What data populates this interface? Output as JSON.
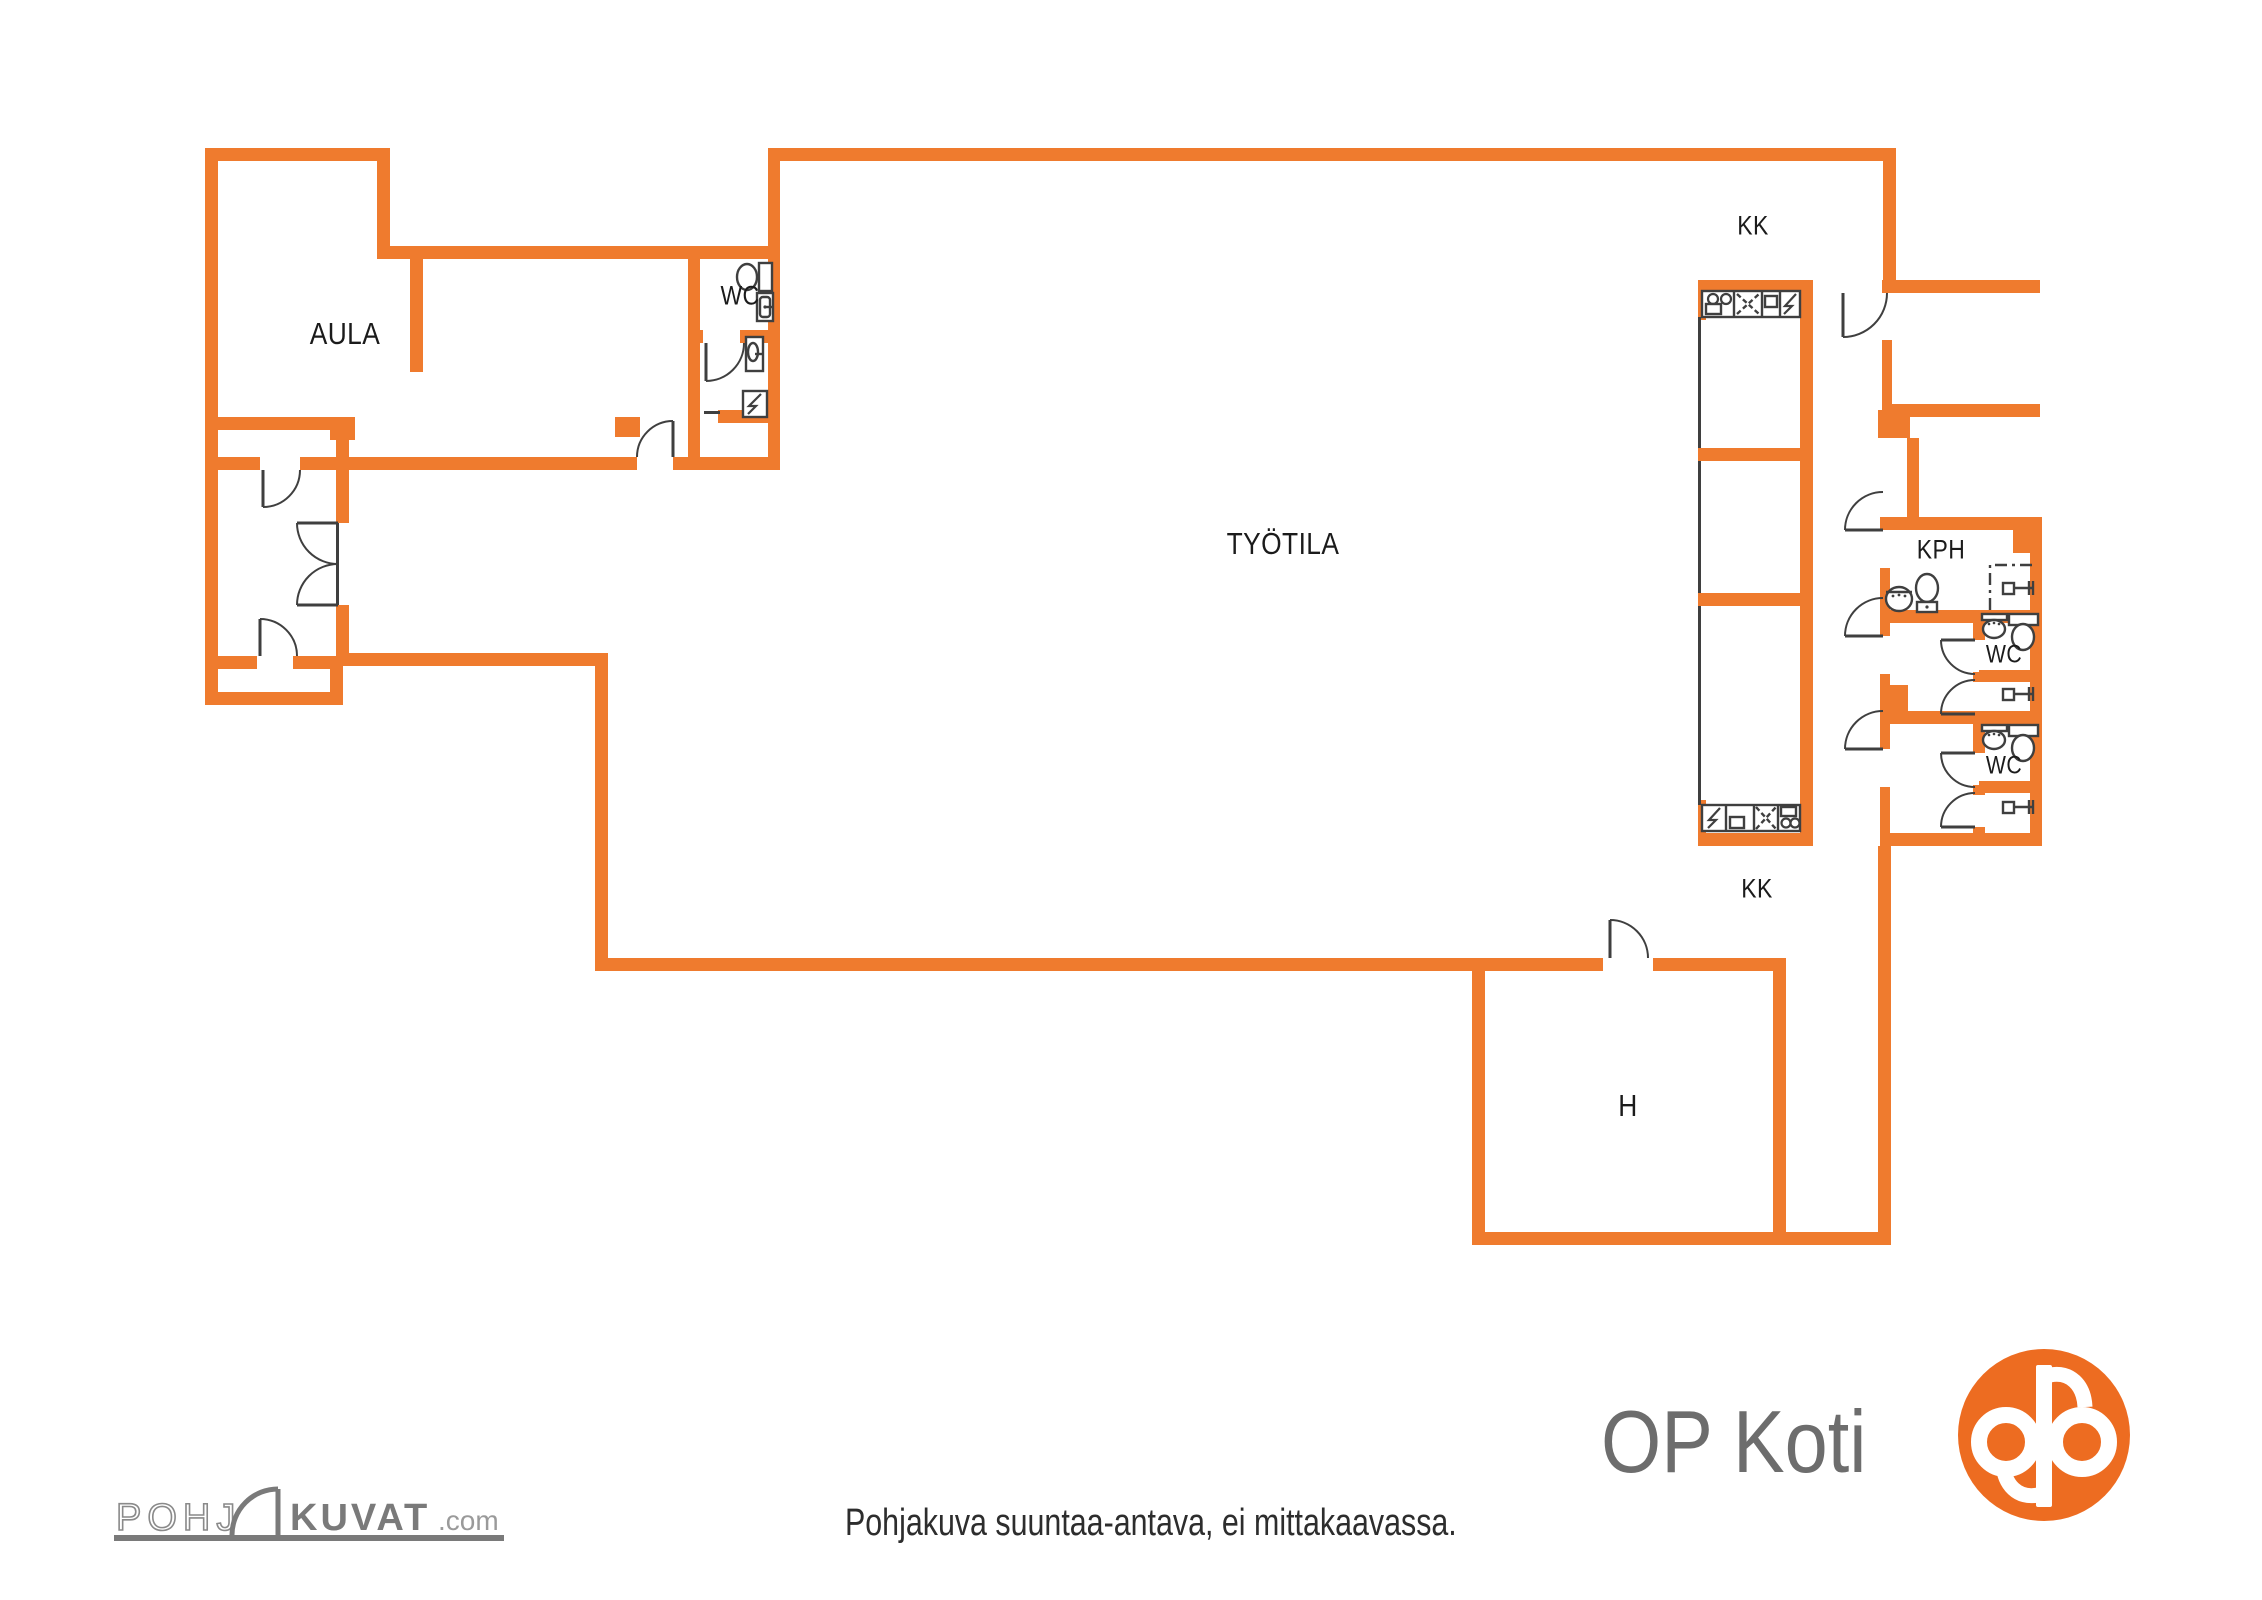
{
  "colors": {
    "wall": "#EF7B2E",
    "line": "#3f3f3f",
    "label": "#1b1b1b",
    "logo_orange": "#ED6C21",
    "logo_gray": "#6d6d6d",
    "watermark_gray": "#7a7a7a"
  },
  "footer": {
    "disclaimer": "Pohjakuva suuntaa-antava, ei mittakaavassa.",
    "brand": "OP Koti",
    "watermark_left": "POHJ",
    "watermark_mid": "KUVAT",
    "watermark_suffix": ".com"
  },
  "rooms": [
    {
      "text": "AULA",
      "x": 345,
      "y": 334,
      "size": 31
    },
    {
      "text": "WC",
      "x": 740,
      "y": 296,
      "size": 27
    },
    {
      "text": "TYÖTILA",
      "x": 1283,
      "y": 544,
      "size": 31
    },
    {
      "text": "KK",
      "x": 1753,
      "y": 226,
      "size": 27
    },
    {
      "text": "KK",
      "x": 1757,
      "y": 889,
      "size": 27
    },
    {
      "text": "KPH",
      "x": 1941,
      "y": 550,
      "size": 27
    },
    {
      "text": "WC",
      "x": 2004,
      "y": 655,
      "size": 25
    },
    {
      "text": "WC",
      "x": 2004,
      "y": 766,
      "size": 25
    },
    {
      "text": "H",
      "x": 1628,
      "y": 1106,
      "size": 31
    }
  ],
  "plan": {
    "width": 2262,
    "height": 1600,
    "walls": [
      [
        205,
        148,
        185,
        13
      ],
      [
        205,
        148,
        13,
        557
      ],
      [
        377,
        148,
        13,
        111
      ],
      [
        377,
        246,
        403,
        13
      ],
      [
        410,
        259,
        13,
        113
      ],
      [
        218,
        417,
        116,
        13
      ],
      [
        330,
        417,
        25,
        23
      ],
      [
        336,
        437,
        13,
        33
      ],
      [
        218,
        457,
        42,
        13
      ],
      [
        300,
        457,
        337,
        13
      ],
      [
        673,
        457,
        107,
        13
      ],
      [
        336,
        470,
        13,
        53
      ],
      [
        336,
        605,
        13,
        51
      ],
      [
        218,
        656,
        39,
        13
      ],
      [
        293,
        656,
        50,
        13
      ],
      [
        205,
        692,
        138,
        13
      ],
      [
        330,
        656,
        13,
        49
      ],
      [
        688,
        259,
        12,
        75
      ],
      [
        688,
        330,
        15,
        13
      ],
      [
        740,
        330,
        40,
        13
      ],
      [
        688,
        343,
        12,
        114
      ],
      [
        768,
        148,
        12,
        322
      ],
      [
        718,
        410,
        62,
        13
      ],
      [
        615,
        417,
        25,
        20
      ],
      [
        768,
        148,
        1121,
        13
      ],
      [
        595,
        653,
        13,
        318
      ],
      [
        336,
        653,
        272,
        13
      ],
      [
        595,
        958,
        1008,
        13
      ],
      [
        1653,
        958,
        124,
        13
      ],
      [
        1472,
        958,
        13,
        287
      ],
      [
        1773,
        958,
        13,
        287
      ],
      [
        1472,
        1232,
        419,
        13
      ],
      [
        1878,
        846,
        13,
        399
      ],
      [
        1698,
        280,
        115,
        13
      ],
      [
        1800,
        280,
        13,
        566
      ],
      [
        1698,
        448,
        102,
        13
      ],
      [
        1698,
        593,
        102,
        13
      ],
      [
        1698,
        833,
        115,
        13
      ],
      [
        1698,
        280,
        8,
        40
      ],
      [
        1698,
        800,
        8,
        46
      ],
      [
        1883,
        148,
        13,
        145
      ],
      [
        1882,
        280,
        158,
        13
      ],
      [
        1882,
        340,
        10,
        77
      ],
      [
        1882,
        404,
        158,
        13
      ],
      [
        1878,
        410,
        32,
        28
      ],
      [
        1907,
        438,
        12,
        80
      ],
      [
        1880,
        517,
        162,
        13
      ],
      [
        2013,
        517,
        29,
        36
      ],
      [
        2030,
        517,
        12,
        329
      ],
      [
        1880,
        568,
        10,
        54
      ],
      [
        1880,
        610,
        162,
        13
      ],
      [
        1880,
        623,
        10,
        13
      ],
      [
        1880,
        674,
        10,
        50
      ],
      [
        1973,
        623,
        12,
        17
      ],
      [
        1973,
        672,
        12,
        10
      ],
      [
        1973,
        714,
        12,
        10
      ],
      [
        1979,
        670,
        63,
        12
      ],
      [
        1880,
        711,
        162,
        13
      ],
      [
        1880,
        685,
        28,
        26
      ],
      [
        1880,
        724,
        10,
        25
      ],
      [
        1880,
        787,
        10,
        59
      ],
      [
        1973,
        724,
        12,
        29
      ],
      [
        1973,
        785,
        12,
        10
      ],
      [
        1973,
        827,
        12,
        18
      ],
      [
        1979,
        781,
        63,
        12
      ],
      [
        1880,
        833,
        162,
        13
      ]
    ],
    "glass": [
      [
        1698,
        317,
        3,
        131
      ],
      [
        1698,
        461,
        3,
        132
      ],
      [
        1698,
        606,
        3,
        199
      ],
      [
        336,
        523,
        3,
        82
      ],
      [
        704,
        411,
        16,
        3
      ]
    ],
    "doors": [
      {
        "leaf": [
          263,
          470,
          263,
          507
        ],
        "arc": "M263,507 A37,37 0 0 0 300,470"
      },
      {
        "leaf": [
          297,
          523,
          338,
          523
        ],
        "arc": "M297,523 A41,41 0 0 0 338,564"
      },
      {
        "leaf": [
          297,
          605,
          338,
          605
        ],
        "arc": "M297,605 A41,41 0 0 1 338,564"
      },
      {
        "leaf": [
          260,
          619,
          260,
          656
        ],
        "arc": "M260,619 A37,37 0 0 1 297,656"
      },
      {
        "leaf": [
          706,
          343,
          706,
          381
        ],
        "arc": "M706,381 A38,38 0 0 0 744,343"
      },
      {
        "leaf": [
          673,
          421,
          673,
          457
        ],
        "arc": "M637,457 A36,36 0 0 1 673,421"
      },
      {
        "leaf": [
          1843,
          293,
          1843,
          337
        ],
        "arc": "M1843,337 A44,44 0 0 0 1887,293"
      },
      {
        "leaf": [
          1845,
          530,
          1883,
          530
        ],
        "arc": "M1845,530 A38,38 0 0 1 1883,492"
      },
      {
        "leaf": [
          1845,
          636,
          1883,
          636
        ],
        "arc": "M1845,636 A38,38 0 0 1 1883,598"
      },
      {
        "leaf": [
          1941,
          640,
          1975,
          640
        ],
        "arc": "M1941,640 A34,34 0 0 0 1975,674"
      },
      {
        "leaf": [
          1941,
          714,
          1975,
          714
        ],
        "arc": "M1941,714 A34,34 0 0 1 1975,680"
      },
      {
        "leaf": [
          1845,
          749,
          1883,
          749
        ],
        "arc": "M1845,749 A38,38 0 0 1 1883,711"
      },
      {
        "leaf": [
          1941,
          753,
          1975,
          753
        ],
        "arc": "M1941,753 A34,34 0 0 0 1975,787"
      },
      {
        "leaf": [
          1941,
          827,
          1975,
          827
        ],
        "arc": "M1941,827 A34,34 0 0 1 1975,793"
      },
      {
        "leaf": [
          1610,
          920,
          1610,
          958
        ],
        "arc": "M1610,920 A38,38 0 0 1 1648,958"
      }
    ],
    "fixtures": [
      {
        "t": "rect",
        "x": 1702,
        "y": 291,
        "w": 98,
        "h": 26
      },
      {
        "t": "line",
        "x1": 1734,
        "y1": 291,
        "x2": 1734,
        "y2": 317
      },
      {
        "t": "line",
        "x1": 1762,
        "y1": 291,
        "x2": 1762,
        "y2": 317
      },
      {
        "t": "line",
        "x1": 1780,
        "y1": 291,
        "x2": 1780,
        "y2": 317
      },
      {
        "t": "circle",
        "cx": 1713,
        "cy": 299,
        "r": 5
      },
      {
        "t": "circle",
        "cx": 1726,
        "cy": 299,
        "r": 5
      },
      {
        "t": "rect",
        "x": 1706,
        "y": 304,
        "w": 15,
        "h": 10
      },
      {
        "t": "line",
        "x1": 1737,
        "y1": 294,
        "x2": 1759,
        "y2": 314,
        "dash": "5 3"
      },
      {
        "t": "line",
        "x1": 1737,
        "y1": 314,
        "x2": 1759,
        "y2": 294,
        "dash": "5 3"
      },
      {
        "t": "rect",
        "x": 1765,
        "y": 296,
        "w": 12,
        "h": 11
      },
      {
        "t": "poly",
        "pts": "1796,294 1785,306 1792,306 1784,314"
      },
      {
        "t": "rect",
        "x": 1702,
        "y": 805,
        "w": 98,
        "h": 26
      },
      {
        "t": "line",
        "x1": 1726,
        "y1": 805,
        "x2": 1726,
        "y2": 831
      },
      {
        "t": "line",
        "x1": 1754,
        "y1": 805,
        "x2": 1754,
        "y2": 831
      },
      {
        "t": "line",
        "x1": 1778,
        "y1": 805,
        "x2": 1778,
        "y2": 831
      },
      {
        "t": "poly",
        "pts": "1720,808 1709,820 1716,820 1708,828"
      },
      {
        "t": "rect",
        "x": 1730,
        "y": 817,
        "w": 14,
        "h": 11
      },
      {
        "t": "line",
        "x1": 1756,
        "y1": 807,
        "x2": 1776,
        "y2": 829,
        "dash": "5 3"
      },
      {
        "t": "line",
        "x1": 1756,
        "y1": 829,
        "x2": 1776,
        "y2": 807,
        "dash": "5 3"
      },
      {
        "t": "rect",
        "x": 1781,
        "y": 807,
        "w": 15,
        "h": 9
      },
      {
        "t": "circle",
        "cx": 1786,
        "cy": 823,
        "r": 4.5
      },
      {
        "t": "circle",
        "cx": 1795,
        "cy": 823,
        "r": 4.5
      },
      {
        "t": "rect",
        "x": 759,
        "y": 263,
        "w": 13,
        "h": 28
      },
      {
        "t": "ellipse",
        "cx": 747,
        "cy": 277,
        "rx": 10,
        "ry": 13
      },
      {
        "t": "rect",
        "x": 757,
        "y": 293,
        "w": 16,
        "h": 28
      },
      {
        "t": "rect",
        "x": 760,
        "y": 297,
        "w": 10,
        "h": 20,
        "rx": 3
      },
      {
        "t": "line",
        "x1": 773,
        "y1": 307,
        "x2": 765,
        "y2": 307
      },
      {
        "t": "dot",
        "cx": 765,
        "cy": 307,
        "r": 1.6
      },
      {
        "t": "rect",
        "x": 746,
        "y": 337,
        "w": 17,
        "h": 34
      },
      {
        "t": "ellipse",
        "cx": 753,
        "cy": 352,
        "rx": 5,
        "ry": 9
      },
      {
        "t": "line",
        "x1": 763,
        "y1": 354,
        "x2": 755,
        "y2": 354
      },
      {
        "t": "rect",
        "x": 743,
        "y": 391,
        "w": 24,
        "h": 26
      },
      {
        "t": "poly",
        "pts": "761,394 749,406 756,406 748,414"
      },
      {
        "t": "ellipse",
        "cx": 1899,
        "cy": 599,
        "rx": 13,
        "ry": 12
      },
      {
        "t": "line",
        "x1": 1886,
        "y1": 592,
        "x2": 1912,
        "y2": 592
      },
      {
        "t": "dot",
        "cx": 1893,
        "cy": 596,
        "r": 1.4
      },
      {
        "t": "dot",
        "cx": 1899,
        "cy": 595,
        "r": 1.4
      },
      {
        "t": "dot",
        "cx": 1905,
        "cy": 596,
        "r": 1.4
      },
      {
        "t": "ellipse",
        "cx": 1927,
        "cy": 588,
        "rx": 11,
        "ry": 14
      },
      {
        "t": "rect",
        "x": 1917,
        "y": 602,
        "w": 20,
        "h": 10
      },
      {
        "t": "dot",
        "cx": 1927,
        "cy": 607,
        "r": 1.6
      },
      {
        "t": "path",
        "d": "M 1990 610 L 1990 565 L 2036 565",
        "dash": "12 5 3 5"
      },
      {
        "t": "rect",
        "x": 2003,
        "y": 583,
        "w": 11,
        "h": 11
      },
      {
        "t": "line",
        "x1": 2014,
        "y1": 588,
        "x2": 2034,
        "y2": 588
      },
      {
        "t": "line",
        "x1": 2029,
        "y1": 581,
        "x2": 2029,
        "y2": 595
      },
      {
        "t": "line",
        "x1": 2033,
        "y1": 581,
        "x2": 2033,
        "y2": 595
      },
      {
        "t": "rect",
        "x": 1982,
        "y": 614,
        "w": 25,
        "h": 6
      },
      {
        "t": "ellipse",
        "cx": 1994,
        "cy": 629,
        "rx": 11,
        "ry": 9
      },
      {
        "t": "dot",
        "cx": 1989,
        "cy": 624,
        "r": 1.3
      },
      {
        "t": "dot",
        "cx": 1994,
        "cy": 623,
        "r": 1.3
      },
      {
        "t": "dot",
        "cx": 1999,
        "cy": 624,
        "r": 1.3
      },
      {
        "t": "rect",
        "x": 2009,
        "y": 614,
        "w": 29,
        "h": 11
      },
      {
        "t": "ellipse",
        "cx": 2023,
        "cy": 637,
        "rx": 11,
        "ry": 13
      },
      {
        "t": "rect",
        "x": 2003,
        "y": 689,
        "w": 11,
        "h": 11
      },
      {
        "t": "line",
        "x1": 2014,
        "y1": 694,
        "x2": 2034,
        "y2": 694
      },
      {
        "t": "line",
        "x1": 2029,
        "y1": 687,
        "x2": 2029,
        "y2": 701
      },
      {
        "t": "line",
        "x1": 2033,
        "y1": 687,
        "x2": 2033,
        "y2": 701
      },
      {
        "t": "rect",
        "x": 1982,
        "y": 725,
        "w": 25,
        "h": 6
      },
      {
        "t": "ellipse",
        "cx": 1994,
        "cy": 740,
        "rx": 11,
        "ry": 9
      },
      {
        "t": "dot",
        "cx": 1989,
        "cy": 735,
        "r": 1.3
      },
      {
        "t": "dot",
        "cx": 1994,
        "cy": 734,
        "r": 1.3
      },
      {
        "t": "dot",
        "cx": 1999,
        "cy": 735,
        "r": 1.3
      },
      {
        "t": "rect",
        "x": 2009,
        "y": 725,
        "w": 29,
        "h": 11
      },
      {
        "t": "ellipse",
        "cx": 2023,
        "cy": 748,
        "rx": 11,
        "ry": 13
      },
      {
        "t": "rect",
        "x": 2003,
        "y": 802,
        "w": 11,
        "h": 11
      },
      {
        "t": "line",
        "x1": 2014,
        "y1": 807,
        "x2": 2034,
        "y2": 807
      },
      {
        "t": "line",
        "x1": 2029,
        "y1": 800,
        "x2": 2029,
        "y2": 814
      },
      {
        "t": "line",
        "x1": 2033,
        "y1": 800,
        "x2": 2033,
        "y2": 814
      }
    ]
  }
}
